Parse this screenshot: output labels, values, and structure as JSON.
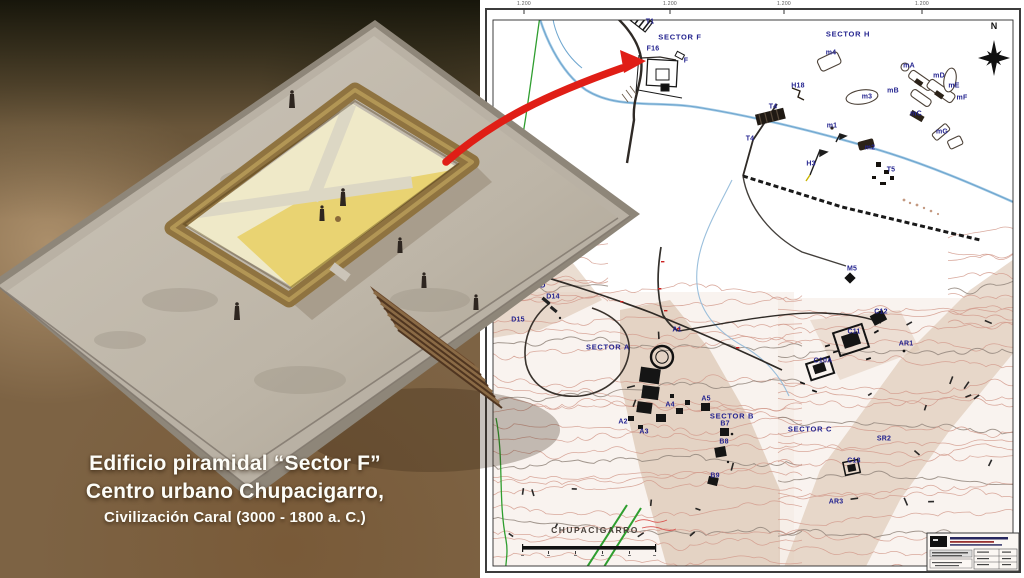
{
  "left_panel": {
    "caption": {
      "line1": "Edificio piramidal “Sector F”",
      "line2": "Centro urbano Chupacigarro,",
      "line3": "Civilización Caral (3000 - 1800 a. C.)"
    }
  },
  "map": {
    "compass_label": "N",
    "site_label": "CHUPACIGARRO",
    "corner_ticks": [
      "1.200",
      "1.200",
      "1.200",
      "1.200"
    ],
    "colors": {
      "label_blue": "#23238f",
      "contour_salmon": "#d29a8c",
      "stream_blue": "#6ea6cf",
      "canal_green": "#2f9e2f",
      "road_black": "#2f2a26",
      "arrow_red": "#e01e16"
    },
    "labels": [
      {
        "text": "T1",
        "x": 170,
        "y": 22
      },
      {
        "text": "SECTOR F",
        "x": 200,
        "y": 37,
        "s": 1
      },
      {
        "text": "F16",
        "x": 173,
        "y": 49
      },
      {
        "text": "F",
        "x": 206,
        "y": 61
      },
      {
        "text": "SECTOR H",
        "x": 368,
        "y": 34,
        "s": 1
      },
      {
        "text": "m4",
        "x": 351,
        "y": 53
      },
      {
        "text": "mA",
        "x": 429,
        "y": 66
      },
      {
        "text": "mD",
        "x": 459,
        "y": 76
      },
      {
        "text": "mB",
        "x": 413,
        "y": 91
      },
      {
        "text": "mE",
        "x": 474,
        "y": 86
      },
      {
        "text": "mF",
        "x": 482,
        "y": 98
      },
      {
        "text": "m3",
        "x": 387,
        "y": 97
      },
      {
        "text": "mC",
        "x": 436,
        "y": 114
      },
      {
        "text": "H18",
        "x": 318,
        "y": 86
      },
      {
        "text": "T4",
        "x": 293,
        "y": 107
      },
      {
        "text": "T4",
        "x": 270,
        "y": 139
      },
      {
        "text": "m1",
        "x": 352,
        "y": 126
      },
      {
        "text": "mG",
        "x": 462,
        "y": 132
      },
      {
        "text": "m2",
        "x": 390,
        "y": 148
      },
      {
        "text": "H3",
        "x": 331,
        "y": 164
      },
      {
        "text": "T5",
        "x": 411,
        "y": 170
      },
      {
        "text": "M5",
        "x": 372,
        "y": 269
      },
      {
        "text": "SECTOR D",
        "x": 44,
        "y": 285,
        "s": 1
      },
      {
        "text": "D14",
        "x": 73,
        "y": 297
      },
      {
        "text": "D15",
        "x": 38,
        "y": 320
      },
      {
        "text": "SECTOR A",
        "x": 128,
        "y": 347,
        "s": 1
      },
      {
        "text": "A1",
        "x": 197,
        "y": 330
      },
      {
        "text": "A4",
        "x": 190,
        "y": 405
      },
      {
        "text": "A5",
        "x": 226,
        "y": 399
      },
      {
        "text": "A2",
        "x": 143,
        "y": 422
      },
      {
        "text": "A3",
        "x": 164,
        "y": 432
      },
      {
        "text": "SECTOR B",
        "x": 252,
        "y": 416,
        "s": 1
      },
      {
        "text": "B7",
        "x": 245,
        "y": 424
      },
      {
        "text": "B8",
        "x": 244,
        "y": 442
      },
      {
        "text": "B9",
        "x": 235,
        "y": 476
      },
      {
        "text": "SECTOR C",
        "x": 330,
        "y": 429,
        "s": 1
      },
      {
        "text": "C12",
        "x": 401,
        "y": 312
      },
      {
        "text": "C11",
        "x": 374,
        "y": 332
      },
      {
        "text": "AR1",
        "x": 426,
        "y": 344
      },
      {
        "text": "C10A",
        "x": 343,
        "y": 361
      },
      {
        "text": "SR2",
        "x": 404,
        "y": 439
      },
      {
        "text": "C13",
        "x": 374,
        "y": 461
      },
      {
        "text": "AR3",
        "x": 356,
        "y": 502
      }
    ]
  }
}
